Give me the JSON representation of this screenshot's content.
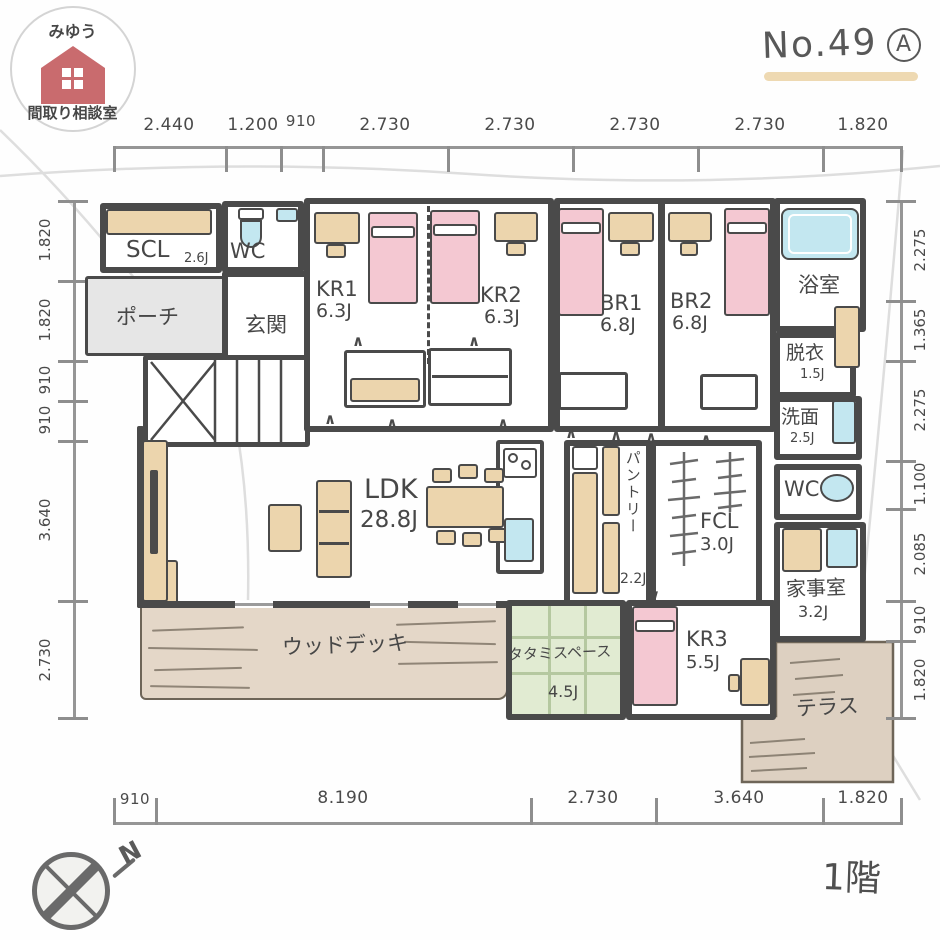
{
  "logo": {
    "top_text": "みゆう",
    "bottom_text": "間取り相談室"
  },
  "header": {
    "plan_no": "No.49",
    "variant": "A"
  },
  "floor_label": "1階",
  "compass_label": "N",
  "colors": {
    "logo_red": "#c96b6e",
    "underline_tan": "#eed9b2",
    "bed_pink": "#f4c8d2",
    "fixture_blue": "#c3e7f0",
    "furniture_tan": "#ecd5ad",
    "tatami_green": "#e1ebd2",
    "deck_tan": "#e4d7c8"
  },
  "dimensions": {
    "top": [
      "2.440",
      "1.200",
      "910",
      "2.730",
      "2.730",
      "2.730",
      "2.730",
      "1.820"
    ],
    "bottom": [
      "910",
      "8.190",
      "2.730",
      "3.640",
      "1.820"
    ],
    "left": [
      "1.820",
      "1.820",
      "910",
      "910",
      "3.640",
      "2.730"
    ],
    "right": [
      "2.275",
      "1.365",
      "2.275",
      "1.100",
      "2.085",
      "910",
      "1.820"
    ]
  },
  "rooms": {
    "scl": {
      "label": "SCL",
      "size": "2.6J"
    },
    "wc1": {
      "label": "WC"
    },
    "porch": {
      "label": "ポーチ"
    },
    "entrance": {
      "label": "玄関"
    },
    "kr1": {
      "label": "KR1",
      "size": "6.3J"
    },
    "kr2": {
      "label": "KR2",
      "size": "6.3J"
    },
    "br1": {
      "label": "BR1",
      "size": "6.8J"
    },
    "br2": {
      "label": "BR2",
      "size": "6.8J"
    },
    "bath": {
      "label": "浴室"
    },
    "datsui": {
      "label": "脱衣",
      "size": "1.5J"
    },
    "senmen": {
      "label": "洗面",
      "size": "2.5J"
    },
    "wc2": {
      "label": "WC"
    },
    "ldk": {
      "label": "LDK",
      "size": "28.8J"
    },
    "pantry": {
      "label": "パントリー",
      "size": "2.2J"
    },
    "fcl": {
      "label": "FCL",
      "size": "3.0J"
    },
    "kaji": {
      "label": "家事室",
      "size": "3.2J"
    },
    "deck": {
      "label": "ウッドデッキ"
    },
    "tatami": {
      "label": "タタミスペース",
      "size": "4.5J"
    },
    "kr3": {
      "label": "KR3",
      "size": "5.5J"
    },
    "terrace": {
      "label": "テラス"
    }
  }
}
